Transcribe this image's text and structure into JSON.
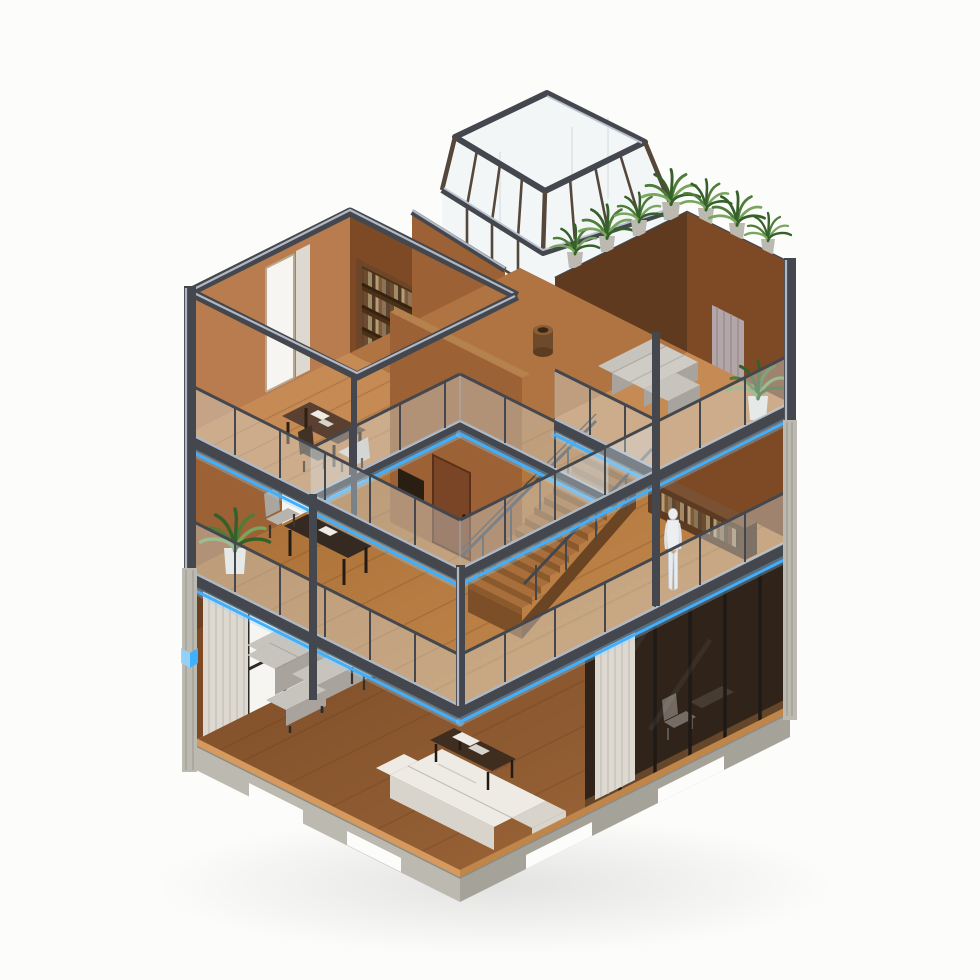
{
  "image": {
    "type": "isometric-architectural-render",
    "description": "Isometric dollhouse-style cutaway render of a modern three-storey timber and steel house: rooftop glass pavilion skylight, concrete roof terrace lined with potted plants, upper study with bookshelf and dining table, mezzanine level with wooden staircase, desk, low bookshelf and a white mannequin figure, double-height living room with grey modular sofa, white L-shaped sofa and coffee table, dark tinted glass den, glass balustrades with glowing blue LED strips, concrete plinth base."
  },
  "palette": {
    "bg": "#fcfcfb",
    "steel": "#44474d",
    "steelDeep": "#33363b",
    "steelLite": "#c5cedb",
    "pavFrame": "#55483a",
    "wood1": "#c68a55",
    "wood2": "#b07442",
    "wood3": "#8d5a31",
    "woodFascia": "#d79a5e",
    "wallL": "#b87c4e",
    "wallM": "#9c6134",
    "wallD": "#7e4a26",
    "wallDD": "#5f3a1f",
    "shelf": "#4b3118",
    "shelfFrame": "#6e4526",
    "conc": "#d7d4cb",
    "concSide": "#bcb9b0",
    "concDark": "#a5a299",
    "glass": "#dce8ee",
    "glassEdge": "#9fb4c0",
    "dkGlass": "#3a2c1f",
    "led": "#3fb0ff",
    "ledGlow": "#8fd4ff",
    "leaf": "#4e7c39",
    "leafD": "#36602a",
    "leafL": "#79a55e",
    "pot": "#c8c5bc",
    "potW": "#ebe9e4",
    "gray1": "#c7c3bd",
    "gray2": "#a8a49d",
    "white1": "#edebe4",
    "white2": "#d8d4cb",
    "curt": "#ddd9d1",
    "curtD": "#c6c1b8",
    "curtMauve": "#b3a6a8",
    "tbl": "#3f2d1f",
    "man": "#eceef0",
    "win": "#f6f5f2"
  },
  "objects": [
    {
      "name": "glass-pavilion",
      "label": "rooftop glass pavilion"
    },
    {
      "name": "roof-terrace",
      "label": "concrete roof terrace with plants"
    },
    {
      "name": "study-room",
      "label": "upper study with bookshelf and table"
    },
    {
      "name": "lounge-room",
      "label": "upper lounge with grey sofa"
    },
    {
      "name": "mezzanine",
      "label": "mezzanine with staircase and mannequin"
    },
    {
      "name": "living-room",
      "label": "double-height living room"
    },
    {
      "name": "den-glass-wall",
      "label": "dark tinted glass den"
    },
    {
      "name": "staircase",
      "label": "wooden staircase"
    },
    {
      "name": "led-strips",
      "label": "blue LED floor-edge lighting"
    },
    {
      "name": "plinth",
      "label": "concrete plinth base"
    }
  ]
}
